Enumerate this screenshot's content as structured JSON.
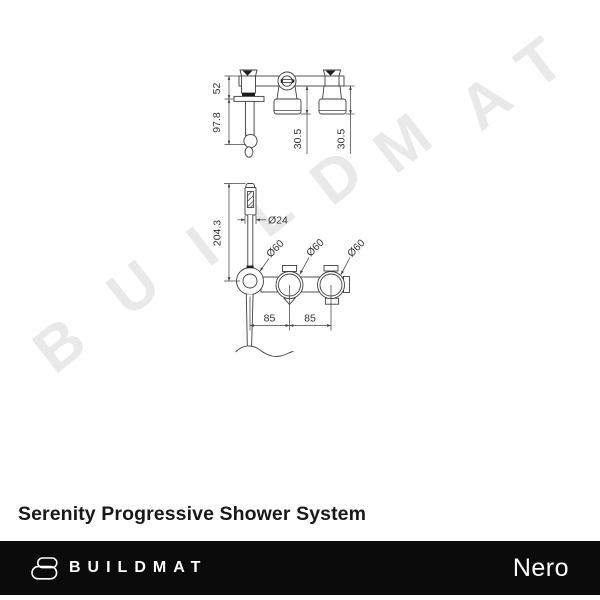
{
  "watermark": {
    "color": "#e9e9e9",
    "letters": [
      "B",
      "U",
      "I",
      "L",
      "D",
      "M",
      "A",
      "T"
    ]
  },
  "diagram": {
    "top_view": {
      "height_upper": "52",
      "height_lower": "97.8",
      "depth_mid": "30.5",
      "depth_right": "30.5"
    },
    "front_view": {
      "handshower_length": "204.3",
      "handpiece_diameter": "Ø24",
      "rosette_diameter_1": "Ø60",
      "rosette_diameter_2": "Ø60",
      "rosette_diameter_3": "Ø60",
      "centres_left": "85",
      "centres_right": "85"
    }
  },
  "product": {
    "title": "Serenity Progressive Shower System"
  },
  "footer": {
    "brand": "BUILDMAT",
    "collection": "Nero",
    "bg_color": "#0b0b0b",
    "text_color": "#ffffff"
  }
}
